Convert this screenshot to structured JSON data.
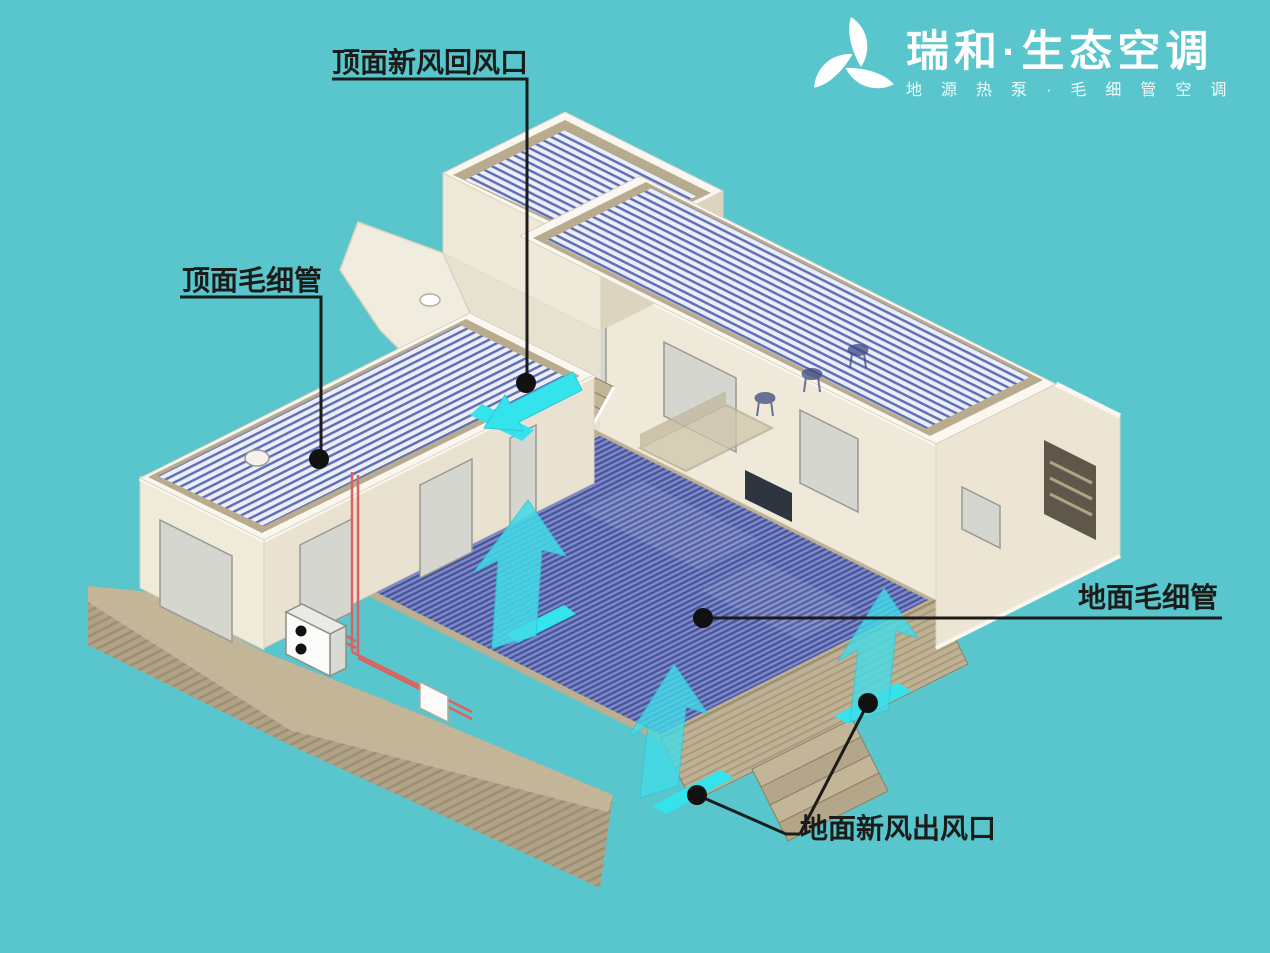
{
  "image_title": "capillary-radiant-hvac-isometric-cutaway",
  "background_color": "#58c6cc",
  "logo": {
    "mark": "triple-leaf-triangle-icon",
    "title": "瑞和·生态空调",
    "subtitle": "地源热泵·毛细管空调",
    "color": "#ffffff"
  },
  "labels": [
    {
      "id": "ceiling-fresh-air-return",
      "text": "顶面新风回风口"
    },
    {
      "id": "ceiling-capillary",
      "text": "顶面毛细管"
    },
    {
      "id": "floor-capillary",
      "text": "地面毛细管"
    },
    {
      "id": "floor-fresh-air-outlet",
      "text": "地面新风出风口"
    }
  ],
  "colors": {
    "background_teal": "#58c6cc",
    "floor_capillary_blue": "#46549e",
    "floor_capillary_gap": "#7e8ac6",
    "ceiling_stripe_blue": "#6170b6",
    "ceiling_panel_light": "#edeff8",
    "wall_cream_lit": "#efe9da",
    "wall_cream_shaded": "#dcd4bf",
    "roof_trim_white": "#f9f7f0",
    "terrain_tan": "#b1a386",
    "walkway_tan": "#bfb193",
    "airflow_cyan": "#35e3ec",
    "pipe_red": "#e0605e",
    "callout_black": "#1b1b19"
  },
  "scene": {
    "description": "Isometric cutaway house showing capillary-tube radiant ceiling and floor mats with fresh-air vents",
    "components": [
      "left-wing-ceiling-capillary-mat",
      "top-room-ceiling-capillary-mat",
      "right-wing-ceiling-capillary-mat",
      "central-floor-capillary-mat",
      "ceiling-fresh-air-return-vent",
      "wall-fresh-air-vent",
      "floor-fresh-air-outlet-vent-left",
      "floor-fresh-air-outlet-vent-right",
      "airflow-arrows-cyan",
      "heat-pump-outdoor-unit",
      "red-refrigerant-pipes",
      "pipe-junction-box",
      "exterior-steps",
      "interior-staircase",
      "terraced-terrain",
      "bar-stools",
      "sofa",
      "wall-tv-panel",
      "ceiling-sensor"
    ]
  }
}
